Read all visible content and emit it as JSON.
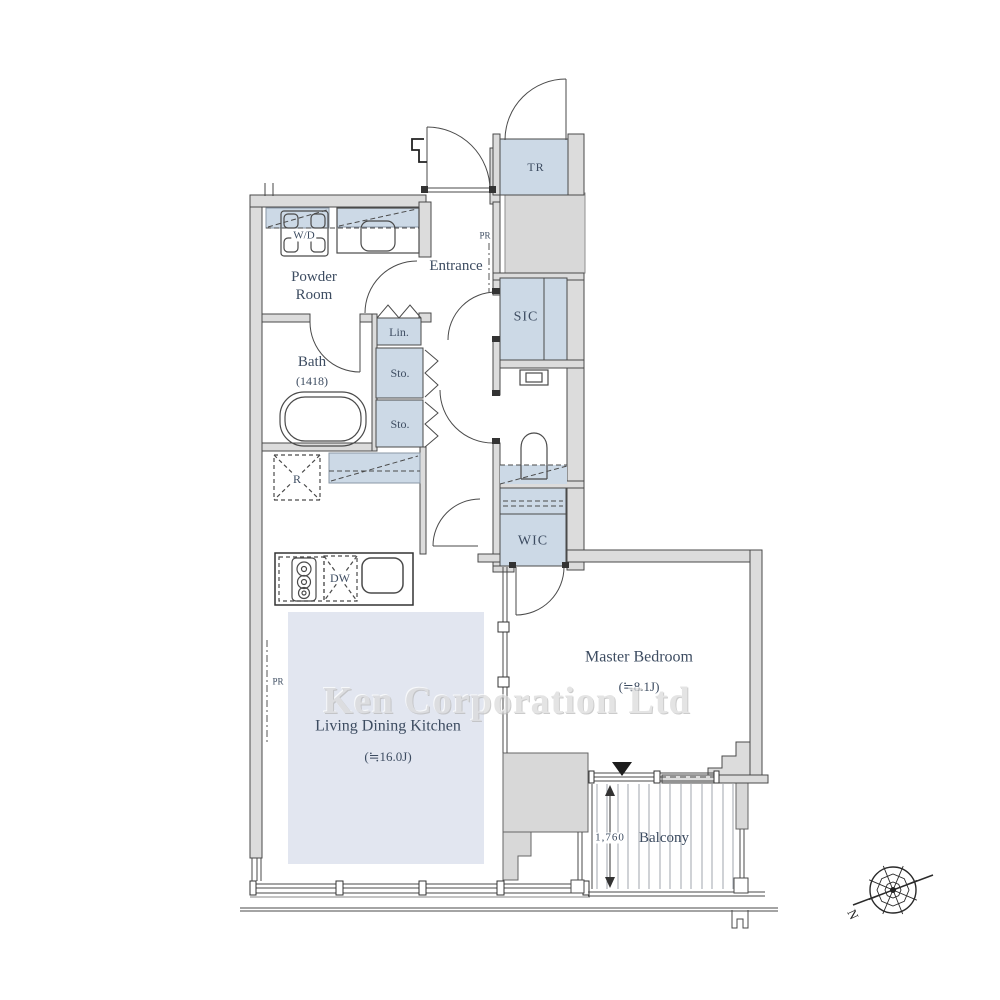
{
  "watermark": "Ken Corporation Ltd",
  "rooms": {
    "entrance": {
      "label": "Entrance"
    },
    "powder_room": {
      "label": "Powder Room"
    },
    "bath": {
      "label": "Bath",
      "size": "(1418)"
    },
    "living_dining_kitchen": {
      "label": "Living Dining Kitchen",
      "size": "(≒16.0J)"
    },
    "master_bedroom": {
      "label": "Master Bedroom",
      "size": "(≒8.1J)"
    },
    "balcony": {
      "label": "Balcony",
      "depth_mm": "1,760"
    },
    "trunk_room": {
      "label": "TR"
    },
    "shoe_in_closet": {
      "label": "SIC"
    },
    "walk_in_closet": {
      "label": "WIC"
    },
    "linen": {
      "label": "Lin."
    },
    "storage_upper": {
      "label": "Sto."
    },
    "storage_lower": {
      "label": "Sto."
    }
  },
  "fixtures": {
    "washer_dryer": {
      "label": "W/D"
    },
    "refrigerator": {
      "label": "R"
    },
    "dishwasher": {
      "label": "DW"
    }
  },
  "annotations": {
    "pipe_space_entrance": {
      "label": "PR"
    },
    "pipe_space_ldk": {
      "label": "PR"
    },
    "compass_north": {
      "label": "N"
    }
  },
  "colors": {
    "closet_fill": "#ccd9e6",
    "ldk_floor_fill": "#e2e6f0",
    "wall_fill": "#dcdcdc",
    "label_text": "#3d4c61"
  }
}
